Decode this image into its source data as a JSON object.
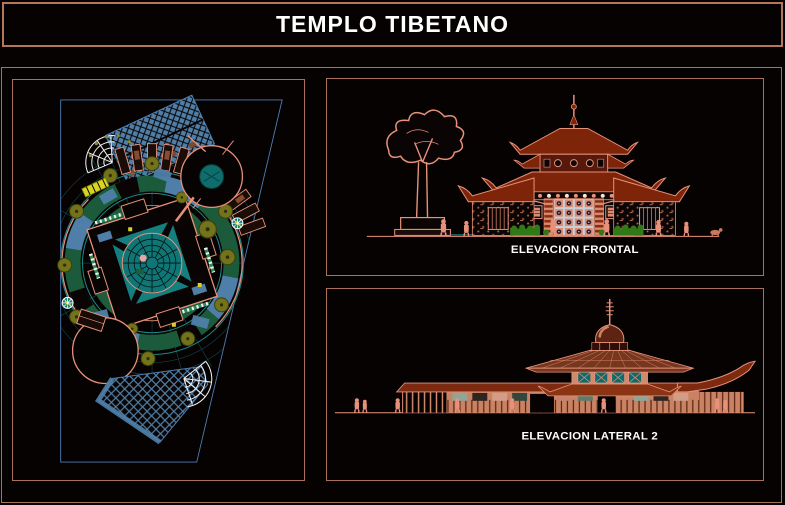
{
  "window": {
    "title": "TEMPLO TIBETANO"
  },
  "views": {
    "front_elevation": {
      "caption": "ELEVACION FRONTAL"
    },
    "side_elevation": {
      "caption": "ELEVACION LATERAL 2"
    }
  },
  "palette": {
    "frame_border": "#A9705A",
    "title_border": "#B5765C",
    "background": "#070202",
    "line_salmon": "#E8917A",
    "roof_red": "#7E2509",
    "wall_pink": "#D08A6E",
    "teal": "#1C8A8A",
    "dark_teal": "#0E6B6B",
    "sea_green": "#1B5A3A",
    "steel_blue": "#4F7FA8",
    "boundary_blue": "#4C7FB5",
    "olive": "#73731C",
    "yellow": "#D8D520",
    "text_white": "#FFFFFF"
  }
}
